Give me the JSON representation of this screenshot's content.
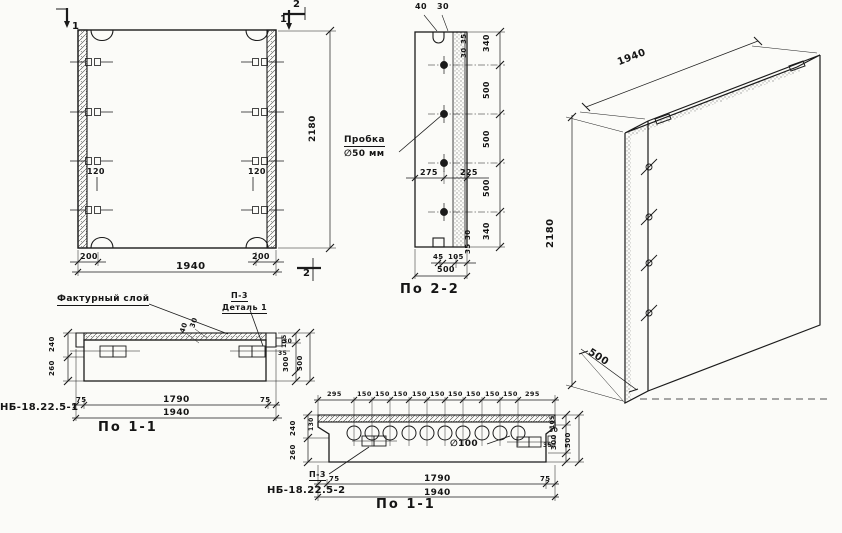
{
  "front_view": {
    "section_marks": {
      "m1_left": "1",
      "m1_right": "1",
      "m2_top": "2",
      "m2_bottom": "2"
    },
    "dims": {
      "height": "2180",
      "width": "1940",
      "edge_left": "200",
      "edge_right": "200",
      "hook_offset_left": "120",
      "hook_offset_right": "120"
    }
  },
  "section_2_2": {
    "title": "По 2-2",
    "plug_callout": {
      "line1": "Пробка",
      "line2": "∅50 мм"
    },
    "dims": {
      "top_a": "40",
      "top_b": "30",
      "top_side_a": "35",
      "top_side_b": "30",
      "heights": [
        "340",
        "500",
        "500",
        "500",
        "340"
      ],
      "mid_left": "275",
      "mid_right": "225",
      "bottom_a": "45",
      "bottom_b": "105",
      "bottom_total": "500",
      "bottom_side_a": "30",
      "bottom_side_b": "35"
    }
  },
  "iso_view": {
    "dims": {
      "width": "1940",
      "height": "2180",
      "depth": "500"
    }
  },
  "section_1_1_a": {
    "name": "НБ-18.22.5-1",
    "title": "По 1-1",
    "callouts": {
      "layer": "Фактурный слой",
      "detail_ref": "П-3",
      "detail_name": "Деталь 1"
    },
    "dims": {
      "layer_a": "40",
      "layer_b": "30",
      "left_top": "240",
      "left_bottom": "260",
      "right_a": "30",
      "right_b": "35",
      "right_c": "105",
      "right_d": "300",
      "right_total": "500",
      "bottom_left": "75",
      "bottom_mid": "1790",
      "bottom_right": "75",
      "bottom_total": "1940"
    }
  },
  "section_1_1_b": {
    "name": "НБ-18.22.5-2",
    "title": "По 1-1",
    "callouts": {
      "detail_ref": "П-3",
      "hole": "∅100"
    },
    "dims": {
      "top": [
        "295",
        "150",
        "150",
        "150",
        "150",
        "150",
        "150",
        "150",
        "150",
        "150",
        "295"
      ],
      "left_top": "240",
      "left_bottom": "260",
      "left_step": "130",
      "right_a": "30",
      "right_b": "35",
      "right_c": "105",
      "right_d": "300",
      "right_total": "500",
      "bottom_left": "75",
      "bottom_mid": "1790",
      "bottom_right": "75",
      "bottom_total": "1940"
    }
  }
}
